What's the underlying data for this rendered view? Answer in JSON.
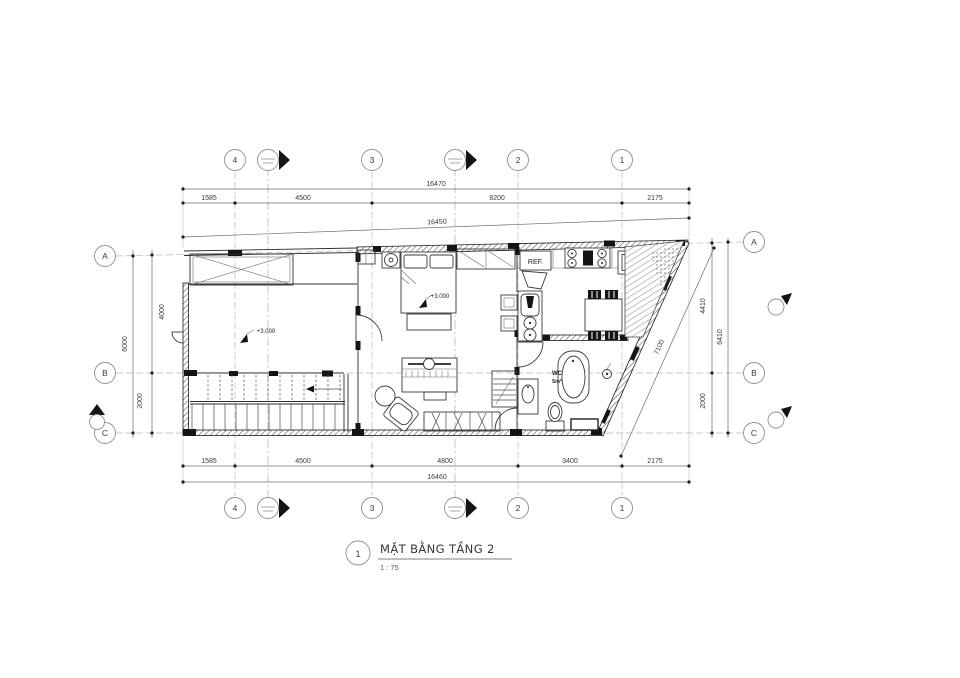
{
  "title_block": {
    "detail_number": "1",
    "title": "MẶT BẰNG TẦNG 2",
    "scale": "1 : 75"
  },
  "grid": {
    "columns": [
      "4",
      "3",
      "2",
      "1"
    ],
    "rows": [
      "A",
      "B",
      "C"
    ]
  },
  "dimensions": {
    "top_total": "16470",
    "top_segments": [
      "1585",
      "4500",
      "8200",
      "2175"
    ],
    "top_wall_length": "16450",
    "bottom_segments": [
      "1585",
      "4500",
      "4800",
      "3400",
      "2175"
    ],
    "bottom_total": "16460",
    "left_segments": [
      "4000",
      "2000"
    ],
    "left_total": "6000",
    "right_segments": [
      "4410",
      "2000"
    ],
    "right_total": "6410",
    "right_diagonal": "7100"
  },
  "labels": {
    "refrigerator": "REF.",
    "washer": "W",
    "wc": "WC",
    "wc_area": "5m²",
    "bedroom_level": "+3.000",
    "living_level": "+3.000"
  }
}
